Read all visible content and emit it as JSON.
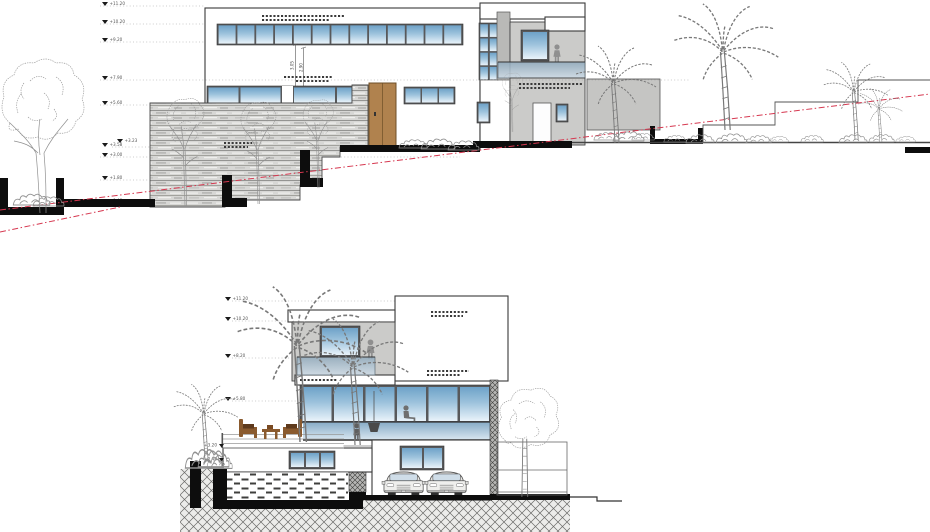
{
  "colors": {
    "glass_dark": "#6ea2c8",
    "glass_mid": "#9cc2dc",
    "glass_light": "#e9f3fa",
    "balcony_glass_dark": "#8fa9bc",
    "balcony_glass_light": "#cfdde8",
    "slab_glass_dark": "#86abc6",
    "slab_glass_light": "#d9e7f1",
    "door_wood": "#b0824e",
    "grade_line_red": "#d63850",
    "volume_gray": "#cbcbc9",
    "wall_gray": "#c5c5c3"
  },
  "top_elevation": {
    "markers": [
      "+11.20",
      "+10.20",
      "+9.20",
      "+7.90",
      "+5.60",
      "+3.58",
      "+3.23",
      "+3.00",
      "+1.80",
      "+0.48"
    ],
    "dimensions": [
      "3.05",
      "2.90"
    ]
  },
  "bottom_section": {
    "markers": [
      "+11.20",
      "+10.20",
      "+8.20",
      "+5.80",
      "+3.20",
      "+2.40"
    ]
  }
}
